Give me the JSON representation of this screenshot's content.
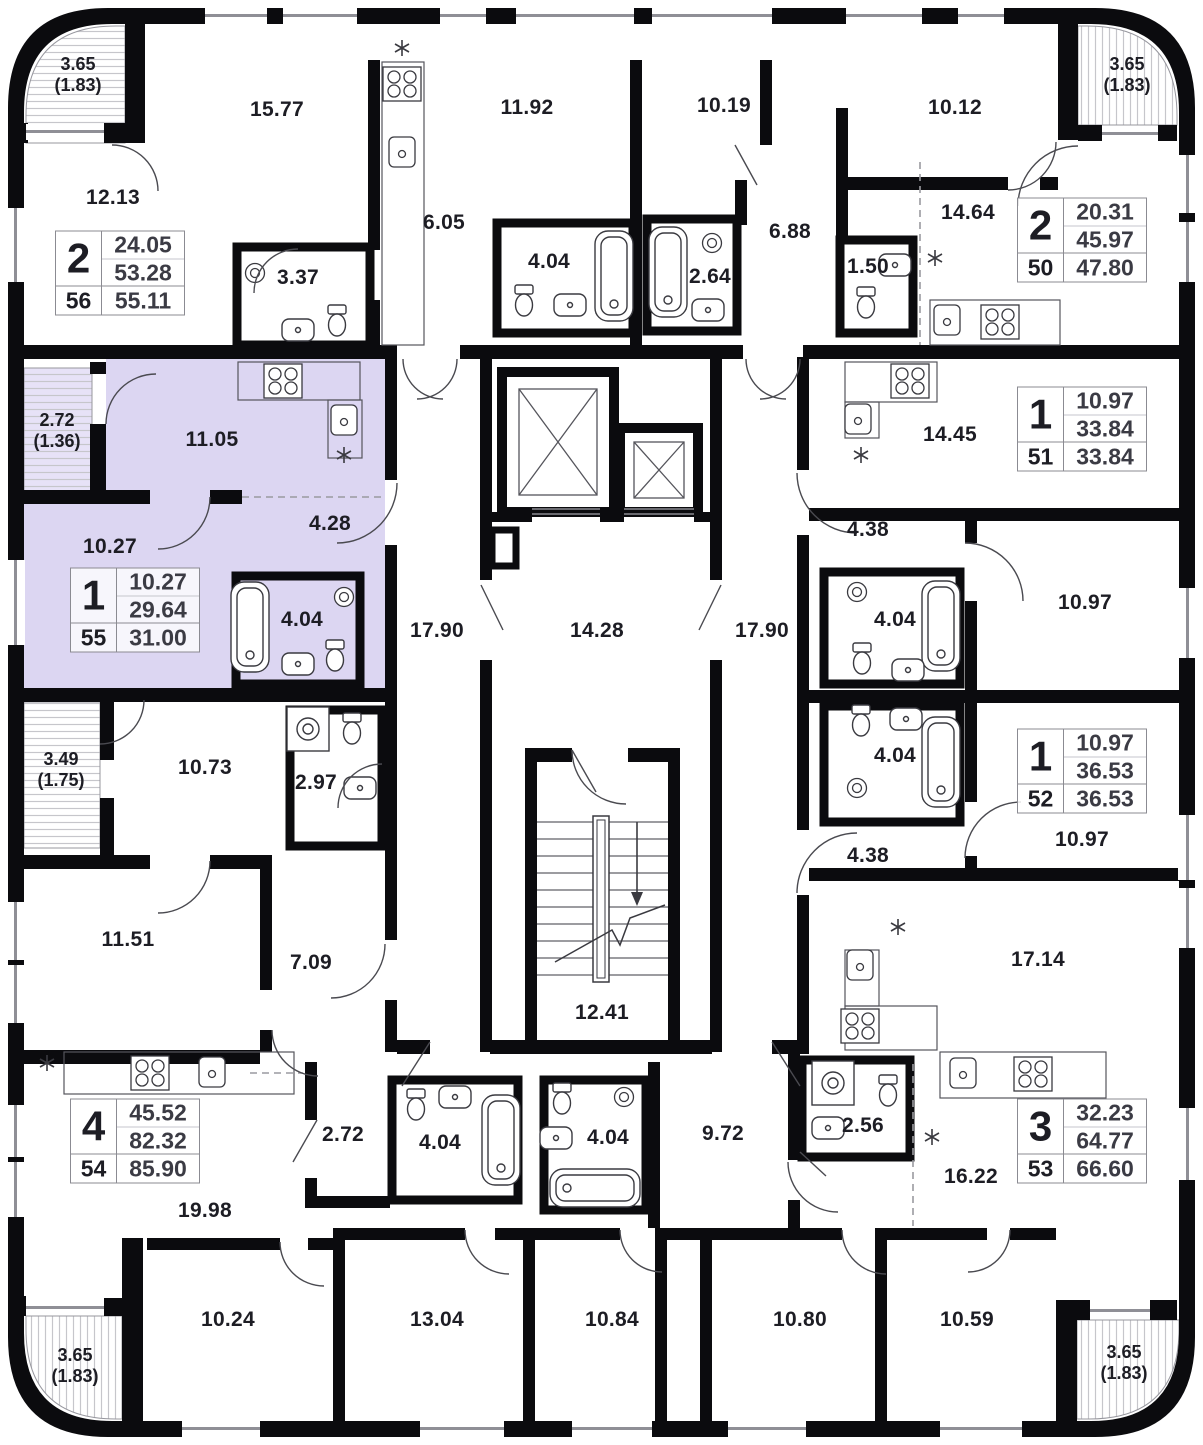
{
  "plan": {
    "type": "residential-floor-plan",
    "highlighted_apartment_number": "55"
  },
  "colors": {
    "wall": "#0b0b0e",
    "text": "#1d1d24",
    "highlight": "#dcd6f2",
    "highlight_balcony": "#e7e2f7",
    "hatch": "#c6c6cb",
    "card_border": "#8b8b92",
    "door": "#4a4a50",
    "fixture": "#3a3a40"
  },
  "room_labels": [
    {
      "text": "15.77",
      "x": 277,
      "y": 110
    },
    {
      "text": "11.92",
      "x": 527,
      "y": 108
    },
    {
      "text": "10.19",
      "x": 724,
      "y": 106
    },
    {
      "text": "10.12",
      "x": 955,
      "y": 108
    },
    {
      "text": "12.13",
      "x": 113,
      "y": 198
    },
    {
      "text": "6.05",
      "x": 444,
      "y": 223
    },
    {
      "text": "3.37",
      "x": 298,
      "y": 278
    },
    {
      "text": "4.04",
      "x": 549,
      "y": 262
    },
    {
      "text": "2.64",
      "x": 710,
      "y": 277
    },
    {
      "text": "6.88",
      "x": 790,
      "y": 232
    },
    {
      "text": "14.64",
      "x": 968,
      "y": 213
    },
    {
      "text": "1.50",
      "x": 868,
      "y": 267
    },
    {
      "text": "11.05",
      "x": 212,
      "y": 440
    },
    {
      "text": "4.28",
      "x": 330,
      "y": 524
    },
    {
      "text": "10.27",
      "x": 110,
      "y": 547
    },
    {
      "text": "4.04",
      "x": 302,
      "y": 620
    },
    {
      "text": "17.90",
      "x": 437,
      "y": 631
    },
    {
      "text": "14.28",
      "x": 597,
      "y": 631
    },
    {
      "text": "17.90",
      "x": 762,
      "y": 631
    },
    {
      "text": "14.45",
      "x": 950,
      "y": 435
    },
    {
      "text": "4.38",
      "x": 868,
      "y": 530
    },
    {
      "text": "4.04",
      "x": 895,
      "y": 620
    },
    {
      "text": "10.97",
      "x": 1085,
      "y": 603
    },
    {
      "text": "10.73",
      "x": 205,
      "y": 768
    },
    {
      "text": "2.97",
      "x": 316,
      "y": 783
    },
    {
      "text": "4.04",
      "x": 895,
      "y": 756
    },
    {
      "text": "10.97",
      "x": 1082,
      "y": 840
    },
    {
      "text": "4.38",
      "x": 868,
      "y": 856
    },
    {
      "text": "11.51",
      "x": 128,
      "y": 940
    },
    {
      "text": "7.09",
      "x": 311,
      "y": 963
    },
    {
      "text": "17.14",
      "x": 1038,
      "y": 960
    },
    {
      "text": "12.41",
      "x": 602,
      "y": 1013
    },
    {
      "text": "19.98",
      "x": 205,
      "y": 1211
    },
    {
      "text": "2.72",
      "x": 343,
      "y": 1135
    },
    {
      "text": "4.04",
      "x": 440,
      "y": 1143
    },
    {
      "text": "4.04",
      "x": 608,
      "y": 1138
    },
    {
      "text": "9.72",
      "x": 723,
      "y": 1134
    },
    {
      "text": "2.56",
      "x": 863,
      "y": 1126
    },
    {
      "text": "16.22",
      "x": 971,
      "y": 1177
    },
    {
      "text": "10.24",
      "x": 228,
      "y": 1320
    },
    {
      "text": "13.04",
      "x": 437,
      "y": 1320
    },
    {
      "text": "10.84",
      "x": 612,
      "y": 1320
    },
    {
      "text": "10.80",
      "x": 800,
      "y": 1320
    },
    {
      "text": "10.59",
      "x": 967,
      "y": 1320
    }
  ],
  "balconies": [
    {
      "area": "3.65",
      "reduced": "(1.83)",
      "x": 78,
      "y": 75
    },
    {
      "area": "3.65",
      "reduced": "(1.83)",
      "x": 1127,
      "y": 75
    },
    {
      "area": "2.72",
      "reduced": "(1.36)",
      "x": 57,
      "y": 431
    },
    {
      "area": "3.49",
      "reduced": "(1.75)",
      "x": 61,
      "y": 770
    },
    {
      "area": "3.65",
      "reduced": "(1.83)",
      "x": 75,
      "y": 1366
    },
    {
      "area": "3.65",
      "reduced": "(1.83)",
      "x": 1124,
      "y": 1363
    }
  ],
  "apartments": [
    {
      "rooms": "2",
      "area1": "24.05",
      "area2": "53.28",
      "number": "56",
      "area_total": "55.11",
      "x": 120,
      "y": 273,
      "highlighted": false
    },
    {
      "rooms": "2",
      "area1": "20.31",
      "area2": "45.97",
      "number": "50",
      "area_total": "47.80",
      "x": 1082,
      "y": 240,
      "highlighted": false
    },
    {
      "rooms": "1",
      "area1": "10.27",
      "area2": "29.64",
      "number": "55",
      "area_total": "31.00",
      "x": 135,
      "y": 610,
      "highlighted": true
    },
    {
      "rooms": "1",
      "area1": "10.97",
      "area2": "33.84",
      "number": "51",
      "area_total": "33.84",
      "x": 1082,
      "y": 429,
      "highlighted": false
    },
    {
      "rooms": "1",
      "area1": "10.97",
      "area2": "36.53",
      "number": "52",
      "area_total": "36.53",
      "x": 1082,
      "y": 771,
      "highlighted": false
    },
    {
      "rooms": "4",
      "area1": "45.52",
      "area2": "82.32",
      "number": "54",
      "area_total": "85.90",
      "x": 135,
      "y": 1141,
      "highlighted": false
    },
    {
      "rooms": "3",
      "area1": "32.23",
      "area2": "64.77",
      "number": "53",
      "area_total": "66.60",
      "x": 1082,
      "y": 1141,
      "highlighted": false
    }
  ]
}
